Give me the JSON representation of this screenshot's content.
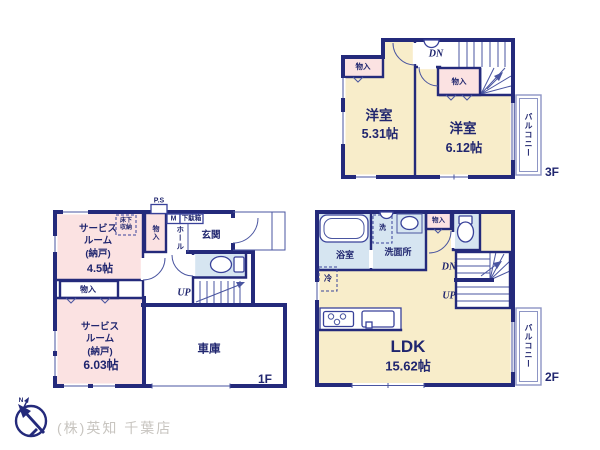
{
  "company": "(株)英知 千葉店",
  "compass": {
    "north_label": "N"
  },
  "palette": {
    "wall": "#242a7b",
    "cream": "#f8edca",
    "pink": "#fbe2e2",
    "blue": "#d6e5f1",
    "balcony_line": "#8d95c4",
    "thin_line": "#4a55a0",
    "label_navy": "#20266f",
    "company_gray": "#c8c5c0"
  },
  "f3": {
    "floor_label": "3F",
    "room1_name": "洋室",
    "room1_area": "5.31帖",
    "room2_name": "洋室",
    "room2_area": "6.12帖",
    "closet_left": "物入",
    "closet_center": "物入",
    "stairs_down": "DN",
    "balcony": "バルコニー"
  },
  "f1": {
    "floor_label": "1F",
    "ps": "P.S",
    "underfloor_storage": "床下\n収納",
    "closet_tall": "物入",
    "meter": "M",
    "shoe_box": "下駄箱",
    "hall": "ホール",
    "entrance": "玄関",
    "service_room1_name": "サービス\nルーム\n(納戸)",
    "service_room1_area": "4.5帖",
    "closet_mid": "物入",
    "service_room2_name": "サービス\nルーム\n(納戸)",
    "service_room2_area": "6.03帖",
    "stairs_up": "UP",
    "garage": "車庫"
  },
  "f2": {
    "floor_label": "2F",
    "bathroom": "浴室",
    "washer": "洗",
    "washroom": "洗面所",
    "closet": "物入",
    "fridge": "冷",
    "stairs_down": "DN",
    "stairs_up": "UP",
    "ldk_name": "LDK",
    "ldk_area": "15.62帖",
    "balcony": "バルコニー"
  }
}
